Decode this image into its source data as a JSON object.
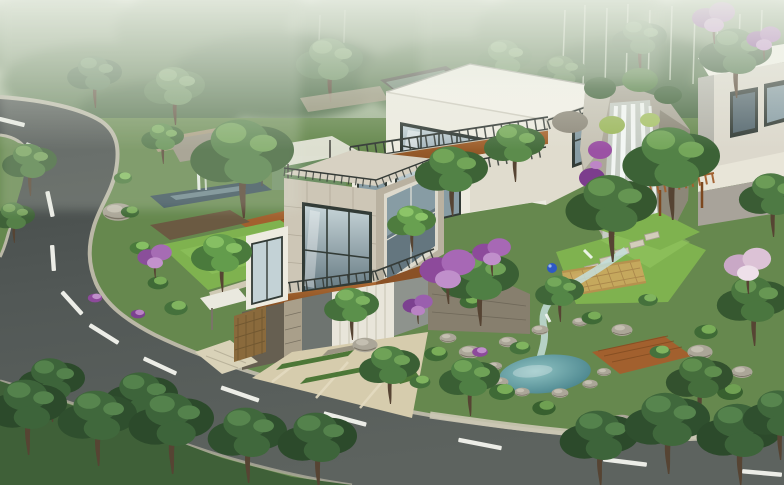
{
  "meta": {
    "title": "Hillside Villa Landscape — Architectural Rendering",
    "description": "Aerial architectural rendering of a modern flat-roofed hillside villa with terraced gardens, a rock waterfall, a teal pond and a curving asphalt road through misty forest."
  },
  "palette": {
    "bgTop": "#c9d3bd",
    "bgMid": "#94aa87",
    "fog": "#e6ecdf",
    "forestA": "#78916d",
    "forestB": "#5f7d55",
    "forestC": "#4d6c46",
    "birch": "#d3dcc8",
    "terrain": "#66884e",
    "terrainDark": "#3f6038",
    "canopyDark": "#3c5f36",
    "canopyMid": "#527d43",
    "canopyLight": "#6fa150",
    "canopyHi": "#8fc168",
    "treeDeep": "#2c4a2b",
    "treeDeepMid": "#3d643a",
    "treeDeepHi": "#54824c",
    "trunk": "#564433",
    "asphaltA": "#444a48",
    "asphaltB": "#5c625f",
    "curb": "#bab7a6",
    "curbLight": "#ccc8b5",
    "marking": "#ecede7",
    "villaWhite": "#edebe0",
    "villaShade": "#e0dcce",
    "villaRoof": "#f3f1e8",
    "roofEdge": "#cfccbf",
    "clerestory": "#54544c",
    "clerestoryGlass": "#7e9a84",
    "panel": "#cdc6b6",
    "panelShade": "#b9b1a0",
    "parapet": "#d7d1c2",
    "grout": "#aba392",
    "frame": "#323b36",
    "glassLight": "#c3d2d6",
    "glassMid": "#879ca4",
    "glassDark": "#55676f",
    "wood": "#a2602e",
    "woodDark": "#7c481f",
    "railing": "#353b37",
    "stone": "#877f6e",
    "stoneDark": "#665f51",
    "stoneLight": "#a99f8a",
    "wallTan": "#a89a7e",
    "garageDoor": "#e8e5da",
    "garageGroove": "#c6c2b3",
    "garageWall": "#8e938d",
    "garageWallDark": "#6e7470",
    "rock": "#aba698",
    "rockLight": "#c6c2b4",
    "waterWhite": "#f6f9f7",
    "waterBase": "#dcebe9",
    "stream": "#c4dedb",
    "pondLight": "#8fc2c2",
    "pondDeep": "#3e7a84",
    "poolDark": "#3a505b",
    "poolLight": "#9db9c0",
    "purple": "#9b52a4",
    "purpleDark": "#7c3d8d",
    "purpleLight": "#bd85c6",
    "pink": "#d4b3cf",
    "pinkLight": "#ecdde8",
    "lattice": "#c9a85e",
    "latticeDark": "#a8854a",
    "lawn": "#7fb24f",
    "lawnHi": "#97c964",
    "grassStrip": "#4d7737",
    "apron": "#d6ccad",
    "apronLight": "#e4dbc0",
    "awning": "#eae9df",
    "gateWood": "#8a6a3c",
    "blueOrnament": "#2e59c5",
    "mist": "#e3e9dc"
  },
  "scene": {
    "setting": {
      "backdrop": "misty forest hillside",
      "atmosphere": "morning fog",
      "viewpoint": "aerial three-quarter"
    },
    "road": {
      "surface": "dark asphalt",
      "markings": "white dashed lane line",
      "marking_count": 12,
      "curb": "light stone curb band",
      "route": "enters at the upper left, hairpins down the hillside and sweeps along the bottom edge"
    },
    "main_villa": {
      "style": "modern cubist",
      "levels": 3,
      "upper_volume": "white cube with dark-framed ribbon glazing",
      "middle_volume": "beige stone-panel cube with corner window",
      "base": "rubble stone plinth",
      "garage_door": "white sectional door",
      "balconies": "timber-faced with dark metal railings",
      "roof": "flat white"
    },
    "second_villa": {
      "position": "upper right, partly hidden by trees",
      "style": "matching white cube"
    },
    "water": {
      "waterfall": "twin cascade over grey rock cliff",
      "stream": "rocky rill feeding the garden pond",
      "pond": "teal oval pond ringed with boulders",
      "reflecting_pool": "dark terrace pool behind the villa"
    },
    "garden": {
      "lawns": "clipped bright green",
      "pergola": "timber slat pergola",
      "lattice_fence": "curved tan lattice fence",
      "stepping_stones": "pale slab path",
      "deck": "timber deck beside the pond",
      "driveway": "pale pavers with grass joints",
      "gate": "timber trellis gate with white canopy"
    },
    "vegetation": {
      "flowering": [
        "purple bougainvillea on the falls",
        "lilac blossom trees",
        "pink blossom tree"
      ],
      "foreground": "dark green canopies along the road edge",
      "background": "fog-veiled forest with birch trunks"
    }
  }
}
